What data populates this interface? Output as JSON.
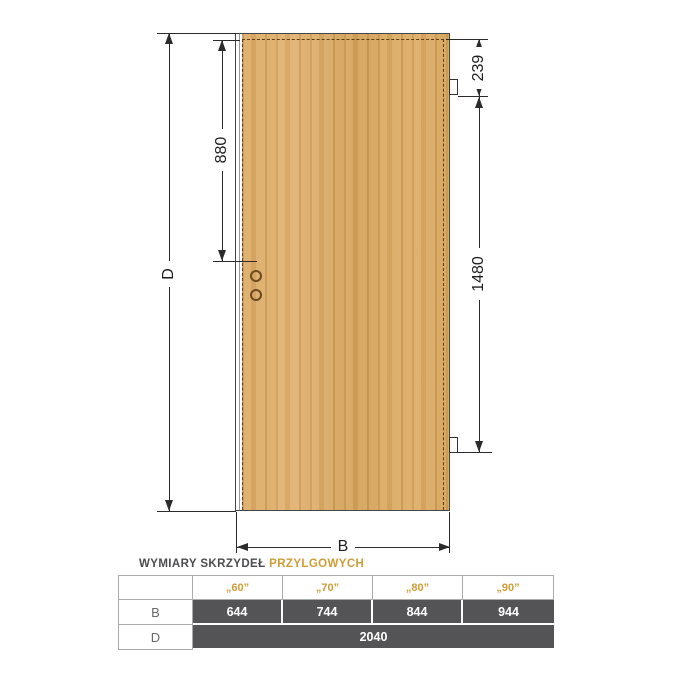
{
  "diagram": {
    "dim_total_height": "D",
    "dim_total_width": "B",
    "dim_handle_height": "880",
    "dim_top_hinge_offset": "239",
    "dim_hinge_spacing": "1480"
  },
  "table": {
    "title": "WYMIARY SKRZYDEŁ",
    "title_accent": "PRZYLGOWYCH",
    "columns": [
      "„60”",
      "„70”",
      "„80”",
      "„90”"
    ],
    "row_b": {
      "label": "B",
      "values": [
        "644",
        "744",
        "844",
        "944"
      ]
    },
    "row_d": {
      "label": "D",
      "value": "2040"
    }
  },
  "colors": {
    "accent_amber": "#cf9d35",
    "cell_dark": "#545456",
    "wood_base": "#d6a55e",
    "dashed_rebate": "#5f3d15",
    "line": "#2b2b2b"
  }
}
